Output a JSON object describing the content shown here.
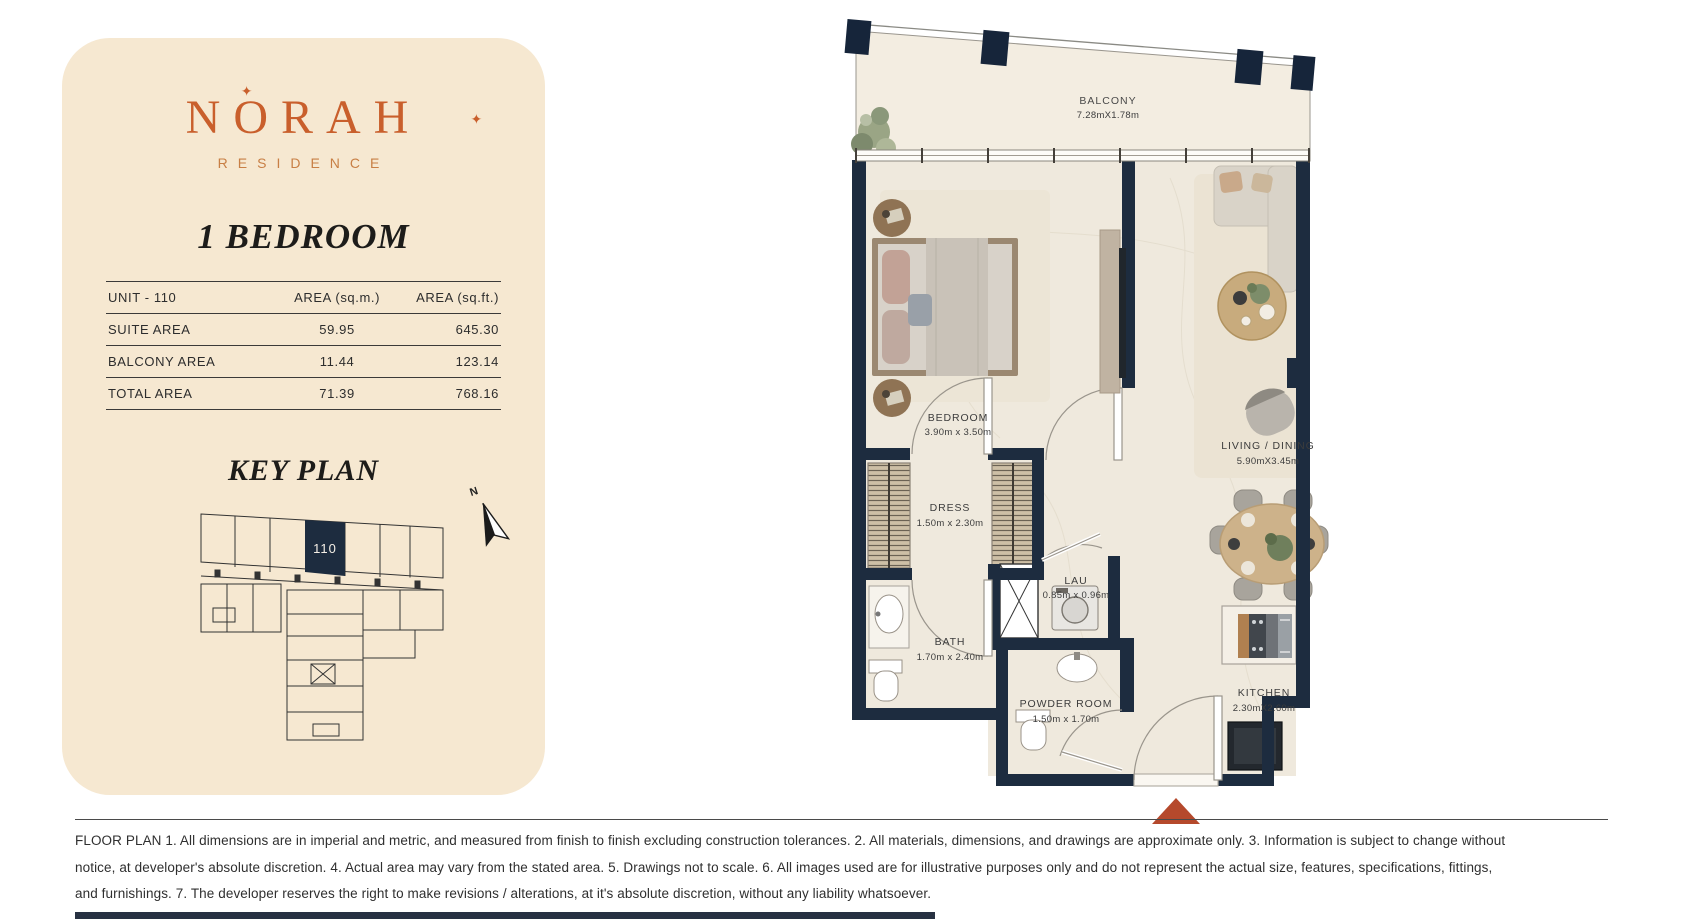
{
  "brand": {
    "name": "NORAH",
    "residence": "RESIDENCE",
    "sparkle": "✦"
  },
  "unit": {
    "type_title": "1 BEDROOM"
  },
  "area_table": {
    "headers": {
      "unit": "UNIT - 110",
      "sqm": "AREA (sq.m.)",
      "sqft": "AREA (sq.ft.)"
    },
    "rows": [
      {
        "label": "SUITE AREA",
        "sqm": "59.95",
        "sqft": "645.30"
      },
      {
        "label": "BALCONY AREA",
        "sqm": "11.44",
        "sqft": "123.14"
      },
      {
        "label": "TOTAL AREA",
        "sqm": "71.39",
        "sqft": "768.16"
      }
    ]
  },
  "key_plan": {
    "title": "KEY PLAN",
    "highlighted_unit": "110",
    "north_label": "N"
  },
  "floor_plan": {
    "rooms": [
      {
        "name": "BALCONY",
        "dims": "7.28mX1.78m"
      },
      {
        "name": "BEDROOM",
        "dims": "3.90m x 3.50m"
      },
      {
        "name": "LIVING / DINING",
        "dims": "5.90mX3.45m"
      },
      {
        "name": "DRESS",
        "dims": "1.50m x 2.30m"
      },
      {
        "name": "BATH",
        "dims": "1.70m x 2.40m"
      },
      {
        "name": "LAU",
        "dims": "0.85m x 0.96m"
      },
      {
        "name": "POWDER ROOM",
        "dims": "1.50m x 1.70m"
      },
      {
        "name": "KITCHEN",
        "dims": "2.30mX2.60m"
      }
    ],
    "colors": {
      "wall": "#1d2c3f",
      "entry_triangle": "#b5492c"
    }
  },
  "disclaimer": {
    "lines": [
      "FLOOR PLAN 1. All dimensions are in imperial and metric, and measured from finish to finish excluding construction tolerances. 2. All materials, dimensions, and drawings are approximate only. 3. Information is subject to change without",
      "notice, at developer's absolute discretion. 4. Actual area may vary from the stated area. 5. Drawings not to scale. 6. All images used are for illustrative purposes only and do not represent the actual size, features, specifications, fittings,",
      "and furnishings. 7. The developer reserves the right to make revisions / alterations, at it's absolute discretion, without any liability whatsoever."
    ]
  }
}
